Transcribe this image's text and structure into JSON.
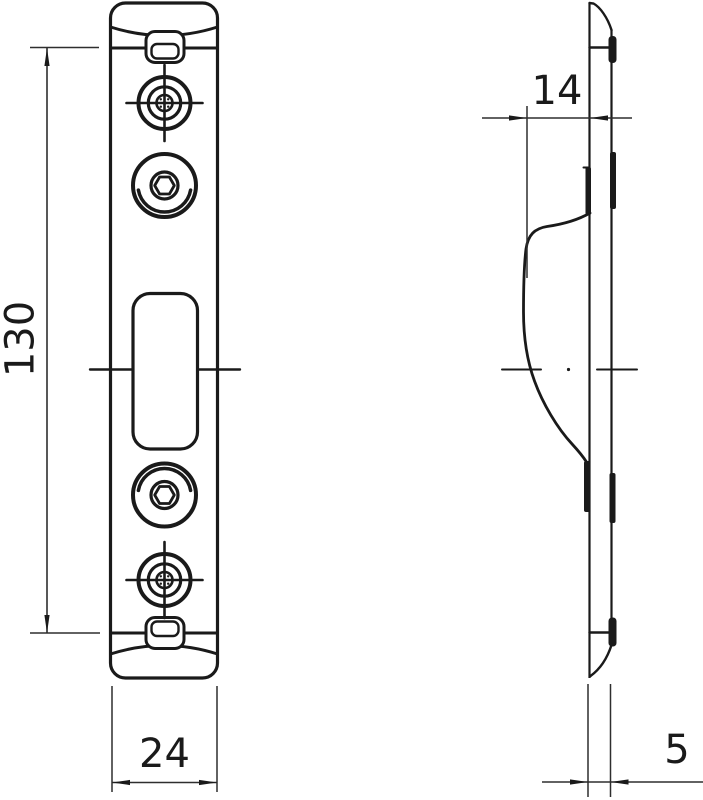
{
  "drawing": {
    "background_color": "#ffffff",
    "line_color": "#1a1a1a",
    "dimension_line_color": "#2e2e2e",
    "views": {
      "front": {
        "features": [
          "top-end-cap",
          "top-retainer-tab",
          "cross-screw-hole-top",
          "hex-socket-screw-top",
          "latch-slot",
          "hex-socket-screw-bottom",
          "cross-screw-hole-bottom",
          "bottom-retainer-tab",
          "center-marks"
        ]
      },
      "side": {
        "features": [
          "plate-profile",
          "keeper-ramp-curve",
          "edge-tabs",
          "center-mark"
        ]
      }
    },
    "dimensions": {
      "height": {
        "label": "130"
      },
      "width": {
        "label": "24"
      },
      "depth": {
        "label": "14"
      },
      "thickness": {
        "label": "5"
      }
    }
  }
}
